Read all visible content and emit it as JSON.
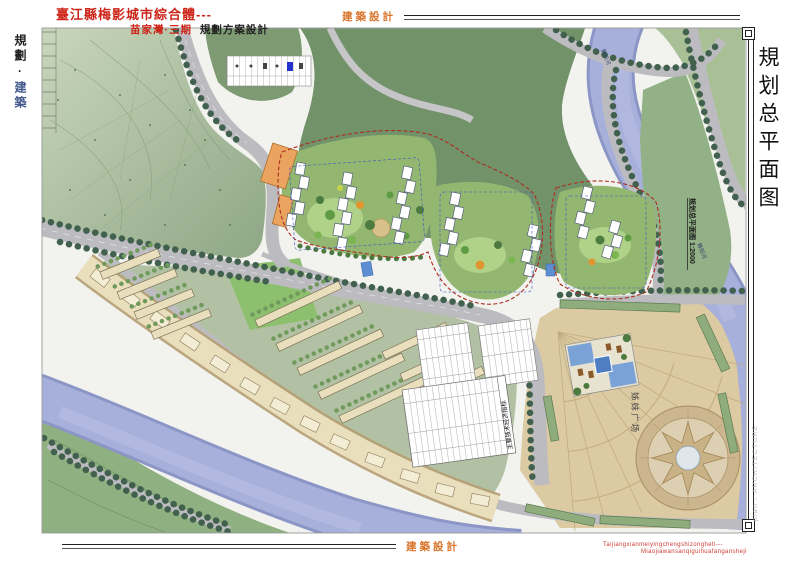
{
  "document": {
    "title_main": "臺江縣梅影城市綜合體---",
    "subtitle_project": "苗家灣·三期",
    "subtitle_type": "規劃方案設計",
    "stamp_top": "建築設計",
    "stamp_bottom": "建築設計",
    "left_label_1": "規劃",
    "left_dot": "·",
    "left_label_2": "建築",
    "drawing_title_vertical": "規划总平面图",
    "side_note_vertical": "plan / ARCHITECTURE",
    "pinyin_line1": "Taijiangxianmeiyingchengshizongheti---",
    "pinyin_line2": "Miaojiawansanqiguihuafangansheji"
  },
  "plan_labels": {
    "river_north": "舞阳河",
    "river_south": "舞阳河",
    "scale_caption": "规划总平面图 1:2000",
    "plaza": "姊妹广场",
    "table_title": "主要技术经济指标"
  },
  "colors": {
    "title_red": "#cc2418",
    "stamp_orange": "#d9762e",
    "left_blue": "#44598c",
    "river_blue": "#a7b0da",
    "park_green": "#9db695",
    "village_green": "#72926a",
    "lawn_green": "#8cc06e",
    "plaza_tan": "#dbcaa2",
    "road_gray": "#bcbcc0",
    "tree_dark": "#41604e",
    "building_cream": "#eadfbd",
    "boundary_red": "#ab2e20"
  }
}
